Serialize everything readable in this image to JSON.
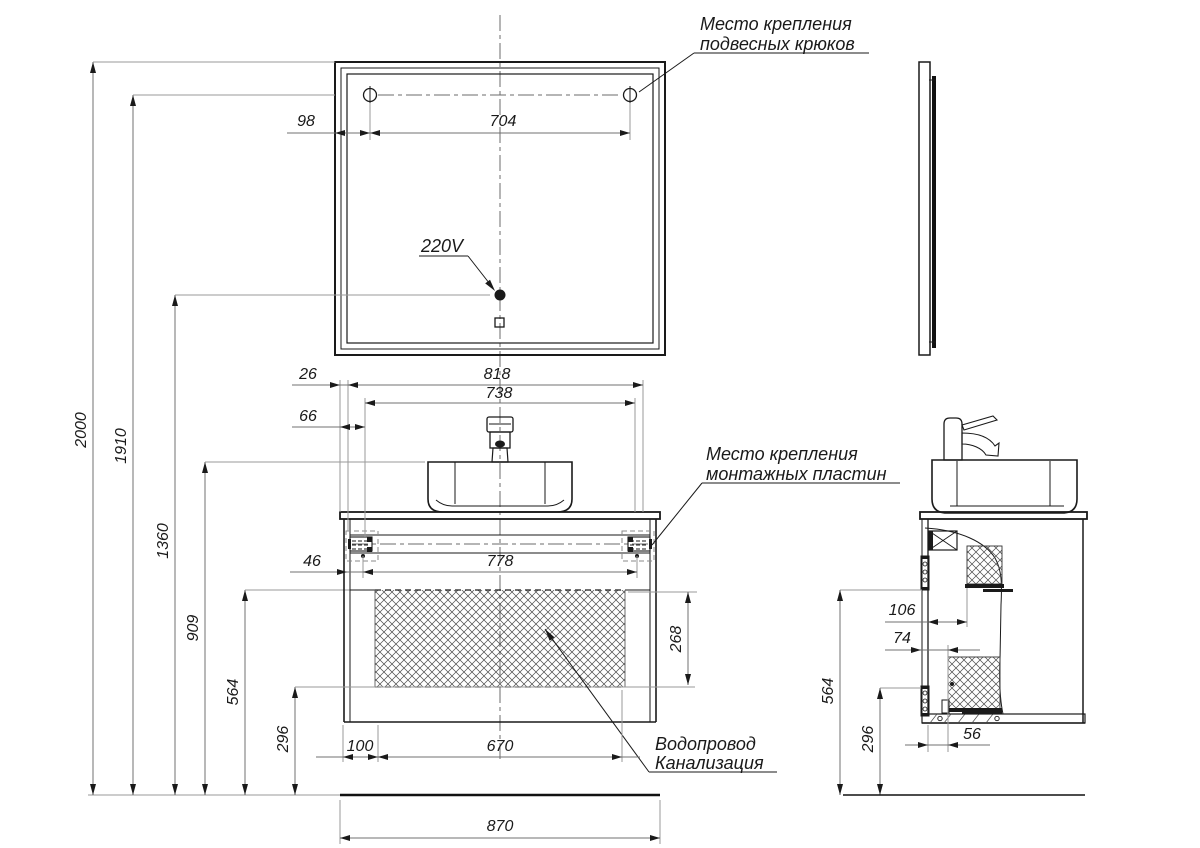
{
  "labels": {
    "hooks_note_line1": "Место крепления",
    "hooks_note_line2": "подвесных крюков",
    "plates_note_line1": "Место крепления",
    "plates_note_line2": "монтажных пластин",
    "voltage": "220V",
    "water": "Водопровод",
    "sewer": "Канализация"
  },
  "dims": {
    "hook_edge": "98",
    "hook_span": "704",
    "h_total": "2000",
    "h_mirror": "1910",
    "h_outlet": "1360",
    "h_sink": "909",
    "h_drawer_top": "564",
    "h_drawer_bot": "296",
    "top_offset": "26",
    "w_cabinet": "818",
    "w_inner": "738",
    "plate_top_offset": "66",
    "plate_side_offset": "46",
    "plate_span": "778",
    "drawer_height": "268",
    "drain_left": "100",
    "drain_span": "670",
    "w_countertop": "870",
    "s_back_gap": "106",
    "s_pipe_offset": "74",
    "s_height": "564",
    "s_lower": "296",
    "s_drain": "56"
  }
}
